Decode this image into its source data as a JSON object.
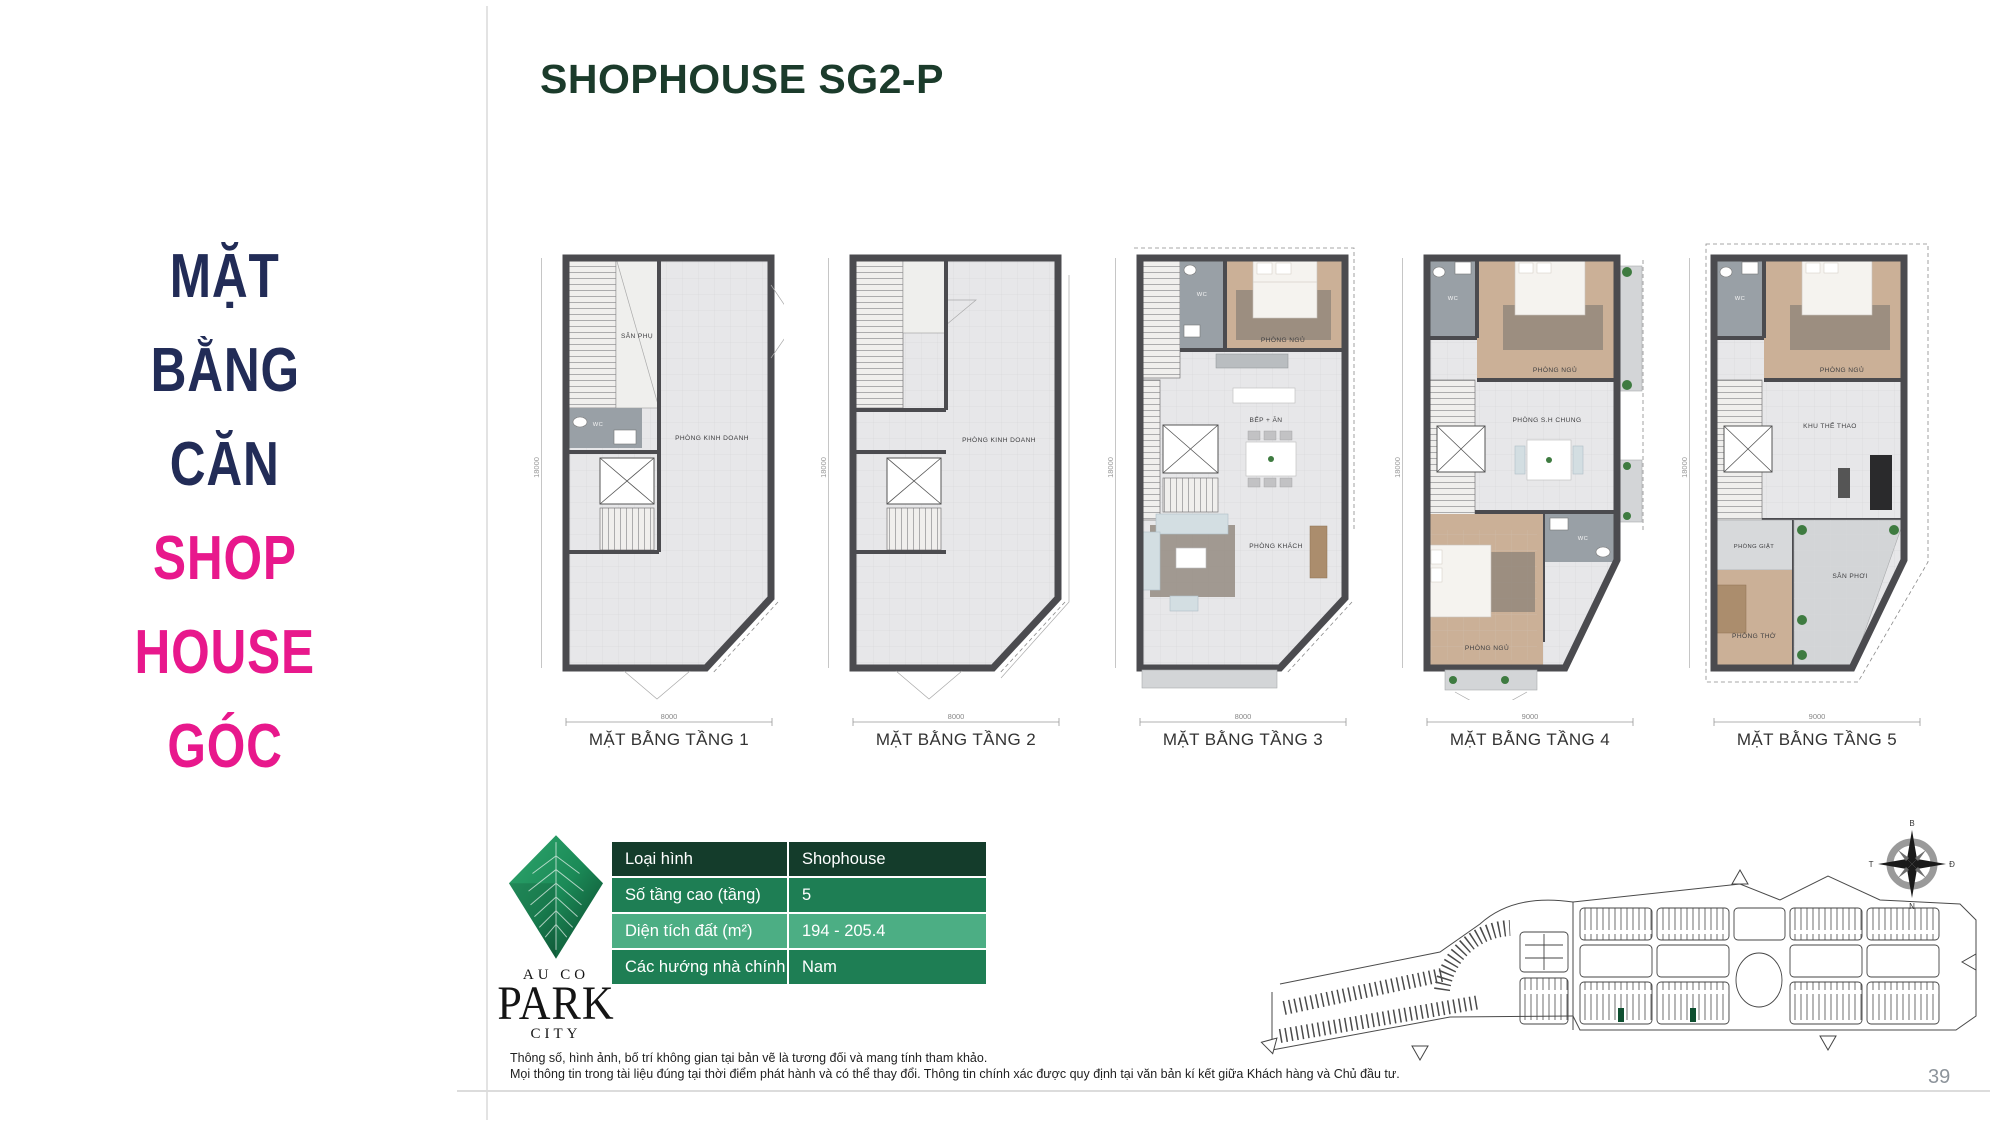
{
  "colors": {
    "navy": "#222c57",
    "pink": "#e8188c",
    "header_green": "#1b3b2b",
    "table_row_dark": "#143c2b",
    "table_row_mid": "#1e7e54",
    "table_row_light": "#4cae84",
    "lot_highlight": "#0e4f30"
  },
  "side_panel": {
    "navy_lines": [
      "MẶT",
      "BẰNG",
      "CĂN"
    ],
    "pink_lines": [
      "SHOP",
      "HOUSE",
      "GÓC"
    ]
  },
  "header": {
    "title": "SHOPHOUSE SG2-P"
  },
  "floor_plans": [
    {
      "label": "MẶT BẰNG TẦNG 1",
      "width_dim": "8000",
      "depth_dim": "18000",
      "rooms": {
        "r1": "SÂN PHỤ",
        "r2": "WC",
        "r3": "PHÒNG KINH DOANH"
      }
    },
    {
      "label": "MẶT BẰNG TẦNG 2",
      "width_dim": "8000",
      "depth_dim": "18000",
      "rooms": {
        "r1": "PHÒNG KINH DOANH"
      }
    },
    {
      "label": "MẶT BẰNG TẦNG 3",
      "width_dim": "8000",
      "depth_dim": "18000",
      "rooms": {
        "r1": "WC",
        "r2": "PHÒNG NGỦ",
        "r3": "BẾP + ĂN",
        "r4": "PHÒNG KHÁCH"
      }
    },
    {
      "label": "MẶT BẰNG TẦNG 4",
      "width_dim": "9000",
      "depth_dim": "18000",
      "rooms": {
        "r1": "WC",
        "r2": "PHÒNG NGỦ",
        "r3": "PHÒNG S.H CHUNG",
        "r4": "WC",
        "r5": "PHÒNG NGỦ"
      }
    },
    {
      "label": "MẶT BẰNG TẦNG 5",
      "width_dim": "9000",
      "depth_dim": "18000",
      "rooms": {
        "r1": "WC",
        "r2": "PHÒNG NGỦ",
        "r3": "KHU THỂ THAO",
        "r4": "PHÒNG GIẶT",
        "r5": "SÂN PHƠI",
        "r6": "PHÒNG THỜ"
      }
    }
  ],
  "info_table": {
    "rows": [
      {
        "label": "Loại hình",
        "value": "Shophouse"
      },
      {
        "label": "Số tầng cao (tầng)",
        "value": "5"
      },
      {
        "label": "Diện tích đất (m²)",
        "value": "194 - 205.4"
      },
      {
        "label": "Các hướng nhà chính",
        "value": "Nam"
      }
    ]
  },
  "logo": {
    "line1": "AU CO",
    "line2": "PARK",
    "line3": "CITY"
  },
  "compass": {
    "north": "B",
    "east": "Đ",
    "south": "N",
    "west": "T"
  },
  "footer": {
    "disclaimer_line1": "Thông số, hình ảnh, bố trí không gian tại bản vẽ là tương đối và mang tính tham khảo.",
    "disclaimer_line2": "Mọi thông tin trong tài liệu đúng tại thời điểm phát hành và có thể thay đổi. Thông tin chính xác được quy định tại văn bản kí kết giữa Khách hàng và Chủ đầu tư.",
    "page_number": "39"
  }
}
